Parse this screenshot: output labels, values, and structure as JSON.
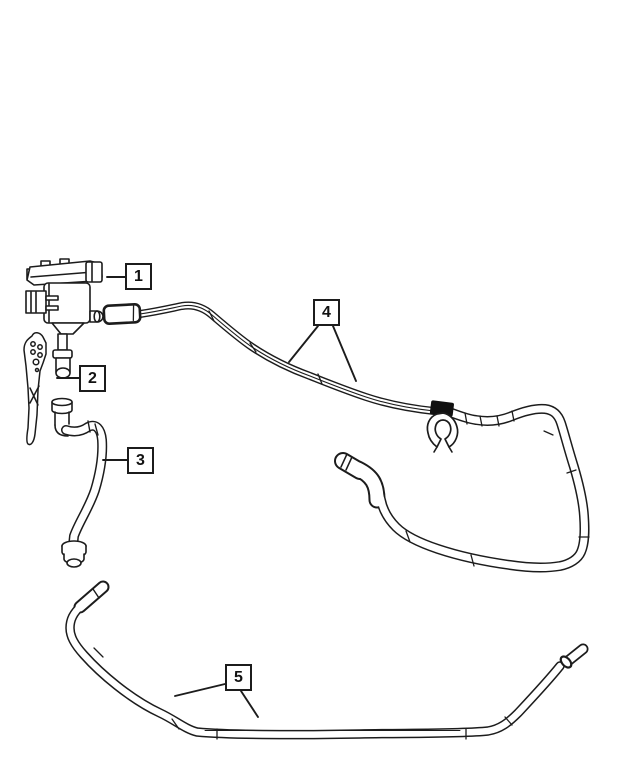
{
  "diagram": {
    "description": "Black-and-white exploded parts line drawing: canister purge valve with mounting bracket, purge hose, vapor tube assembly with retaining clip and elbow fitting, and long vent hose, identified by five numbered callouts",
    "background_color": "#ffffff",
    "line_color": "#1c1c1c",
    "clip_fill_color": "#111111"
  },
  "callouts": [
    {
      "label": "1"
    },
    {
      "label": "2"
    },
    {
      "label": "3"
    },
    {
      "label": "4"
    },
    {
      "label": "5"
    }
  ]
}
